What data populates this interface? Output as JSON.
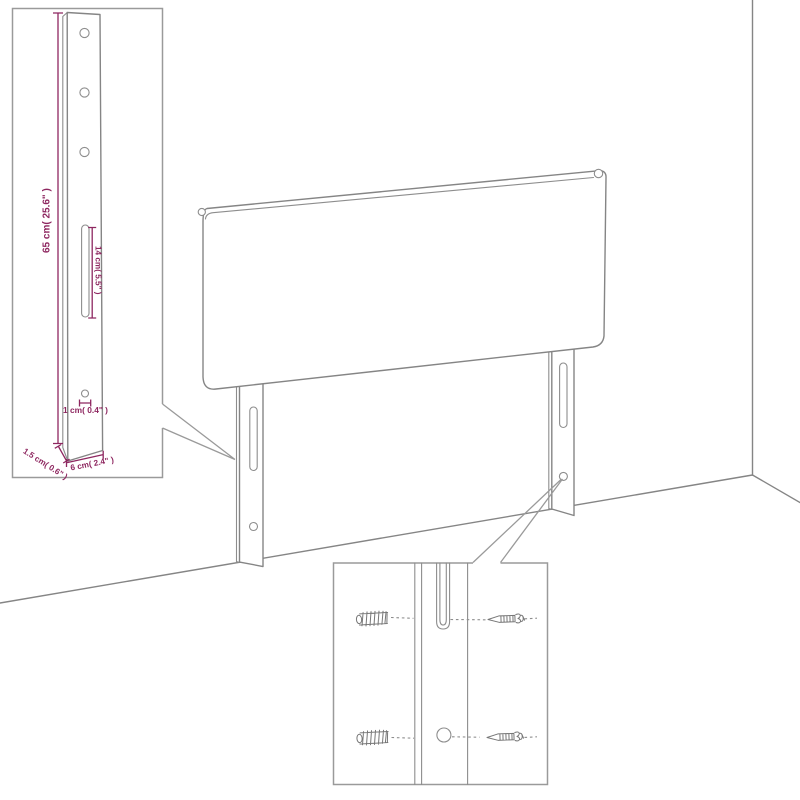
{
  "diagram": {
    "type": "furniture-assembly-dimension-diagram",
    "product": "upholstered headboard with two mounting legs, shown against a wall corner",
    "insets": {
      "leg_detail": "full leg with 3 holes, long slot, small hole, width and depth dimensions",
      "hardware_detail": "close-up of leg slot and hole with wall plugs and screws"
    },
    "labels": {
      "leg_height": "65 cm( 25.6\" )",
      "slot_length": "14 cm( 5.5\" )",
      "hole_diameter": "1 cm( 0.4\" )",
      "leg_depth": "1.5 cm( 0.6\" )",
      "leg_width": "6 cm( 2.4\" )"
    },
    "colors": {
      "outline_gray": "#858585",
      "inset_border_gray": "#9a9a9a",
      "dimension_magenta": "#8e2760",
      "background": "#ffffff"
    }
  }
}
